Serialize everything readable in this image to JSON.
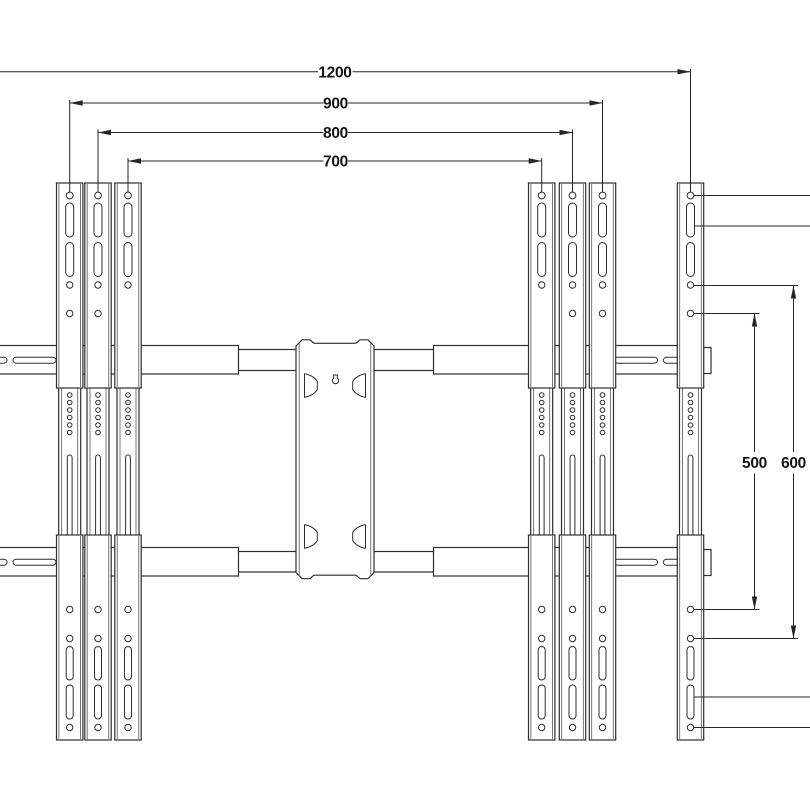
{
  "drawing": {
    "colors": {
      "background": "#ffffff",
      "line": "#2e2e2e",
      "dimension_text": "#141414"
    },
    "dimensions": {
      "horizontal": [
        {
          "label": "1200"
        },
        {
          "label": "900"
        },
        {
          "label": "800"
        },
        {
          "label": "700"
        }
      ],
      "vertical": [
        {
          "label": "500"
        },
        {
          "label": "600"
        }
      ]
    }
  }
}
